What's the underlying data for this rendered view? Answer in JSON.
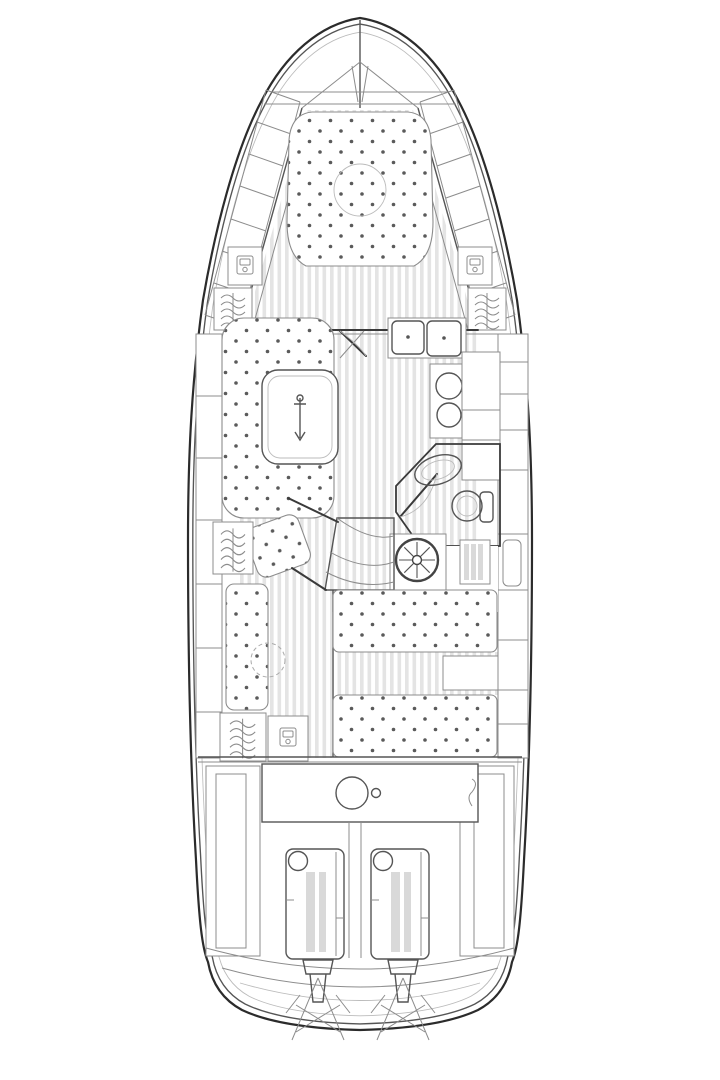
{
  "meta": {
    "title": "Motor yacht interior floor plan — top-down line drawing",
    "drawing_type": "technical CAD-style floor plan, no text labels",
    "orientation": "bow at top, stern with twin engines at bottom"
  },
  "canvas": {
    "width": 720,
    "height": 1080,
    "background": "#ffffff"
  },
  "colors": {
    "hull_line": "#2b2b2b",
    "wall_line": "#3a3a3a",
    "detail_line": "#555555",
    "furniture_line": "#8c8c8c",
    "faint_line": "#bbbbbb",
    "plank_stripe": "#e4e4e4",
    "cushion_dot": "#5a5a5a",
    "panel_gray": "#d9d9d9"
  },
  "areas": {
    "bow": {
      "features": [
        "bow pulpit with anchor fitting",
        "two deck crossbars",
        "port and starboard side-deck steps"
      ]
    },
    "forward_cabin": {
      "bed": "V-berth island double bed with button-tufted mattress",
      "overhead_hatch": "round deck hatch over bed",
      "storage": [
        "port locker unit",
        "starboard locker unit",
        "port hanging wardrobe",
        "starboard hanging wardrobe"
      ]
    },
    "salon": {
      "dinette": "U-shaped settee to port with oval pedestal table",
      "galley": {
        "sinks": 2,
        "stove_burners": 2,
        "cabinets": "starboard counter run"
      }
    },
    "head_compartment": {
      "fixtures": [
        "washbasin",
        "marine toilet",
        "shower grate"
      ]
    },
    "helm": {
      "steering_wheel_spokes": 8
    },
    "companionway": {
      "steps": 3,
      "leads_to": "aft cabin"
    },
    "aft_cabin": {
      "berths": 2,
      "bench": "port lounge seat with folding table (dashed circle)",
      "wardrobe": "hanging locker with small utility unit"
    },
    "cockpit": {
      "engine_hatch": "rectangular hatch with round access port"
    },
    "machinery": {
      "engines": 2,
      "sterndrives": 2,
      "propellers": "crossed-blade symbols below transom"
    }
  }
}
